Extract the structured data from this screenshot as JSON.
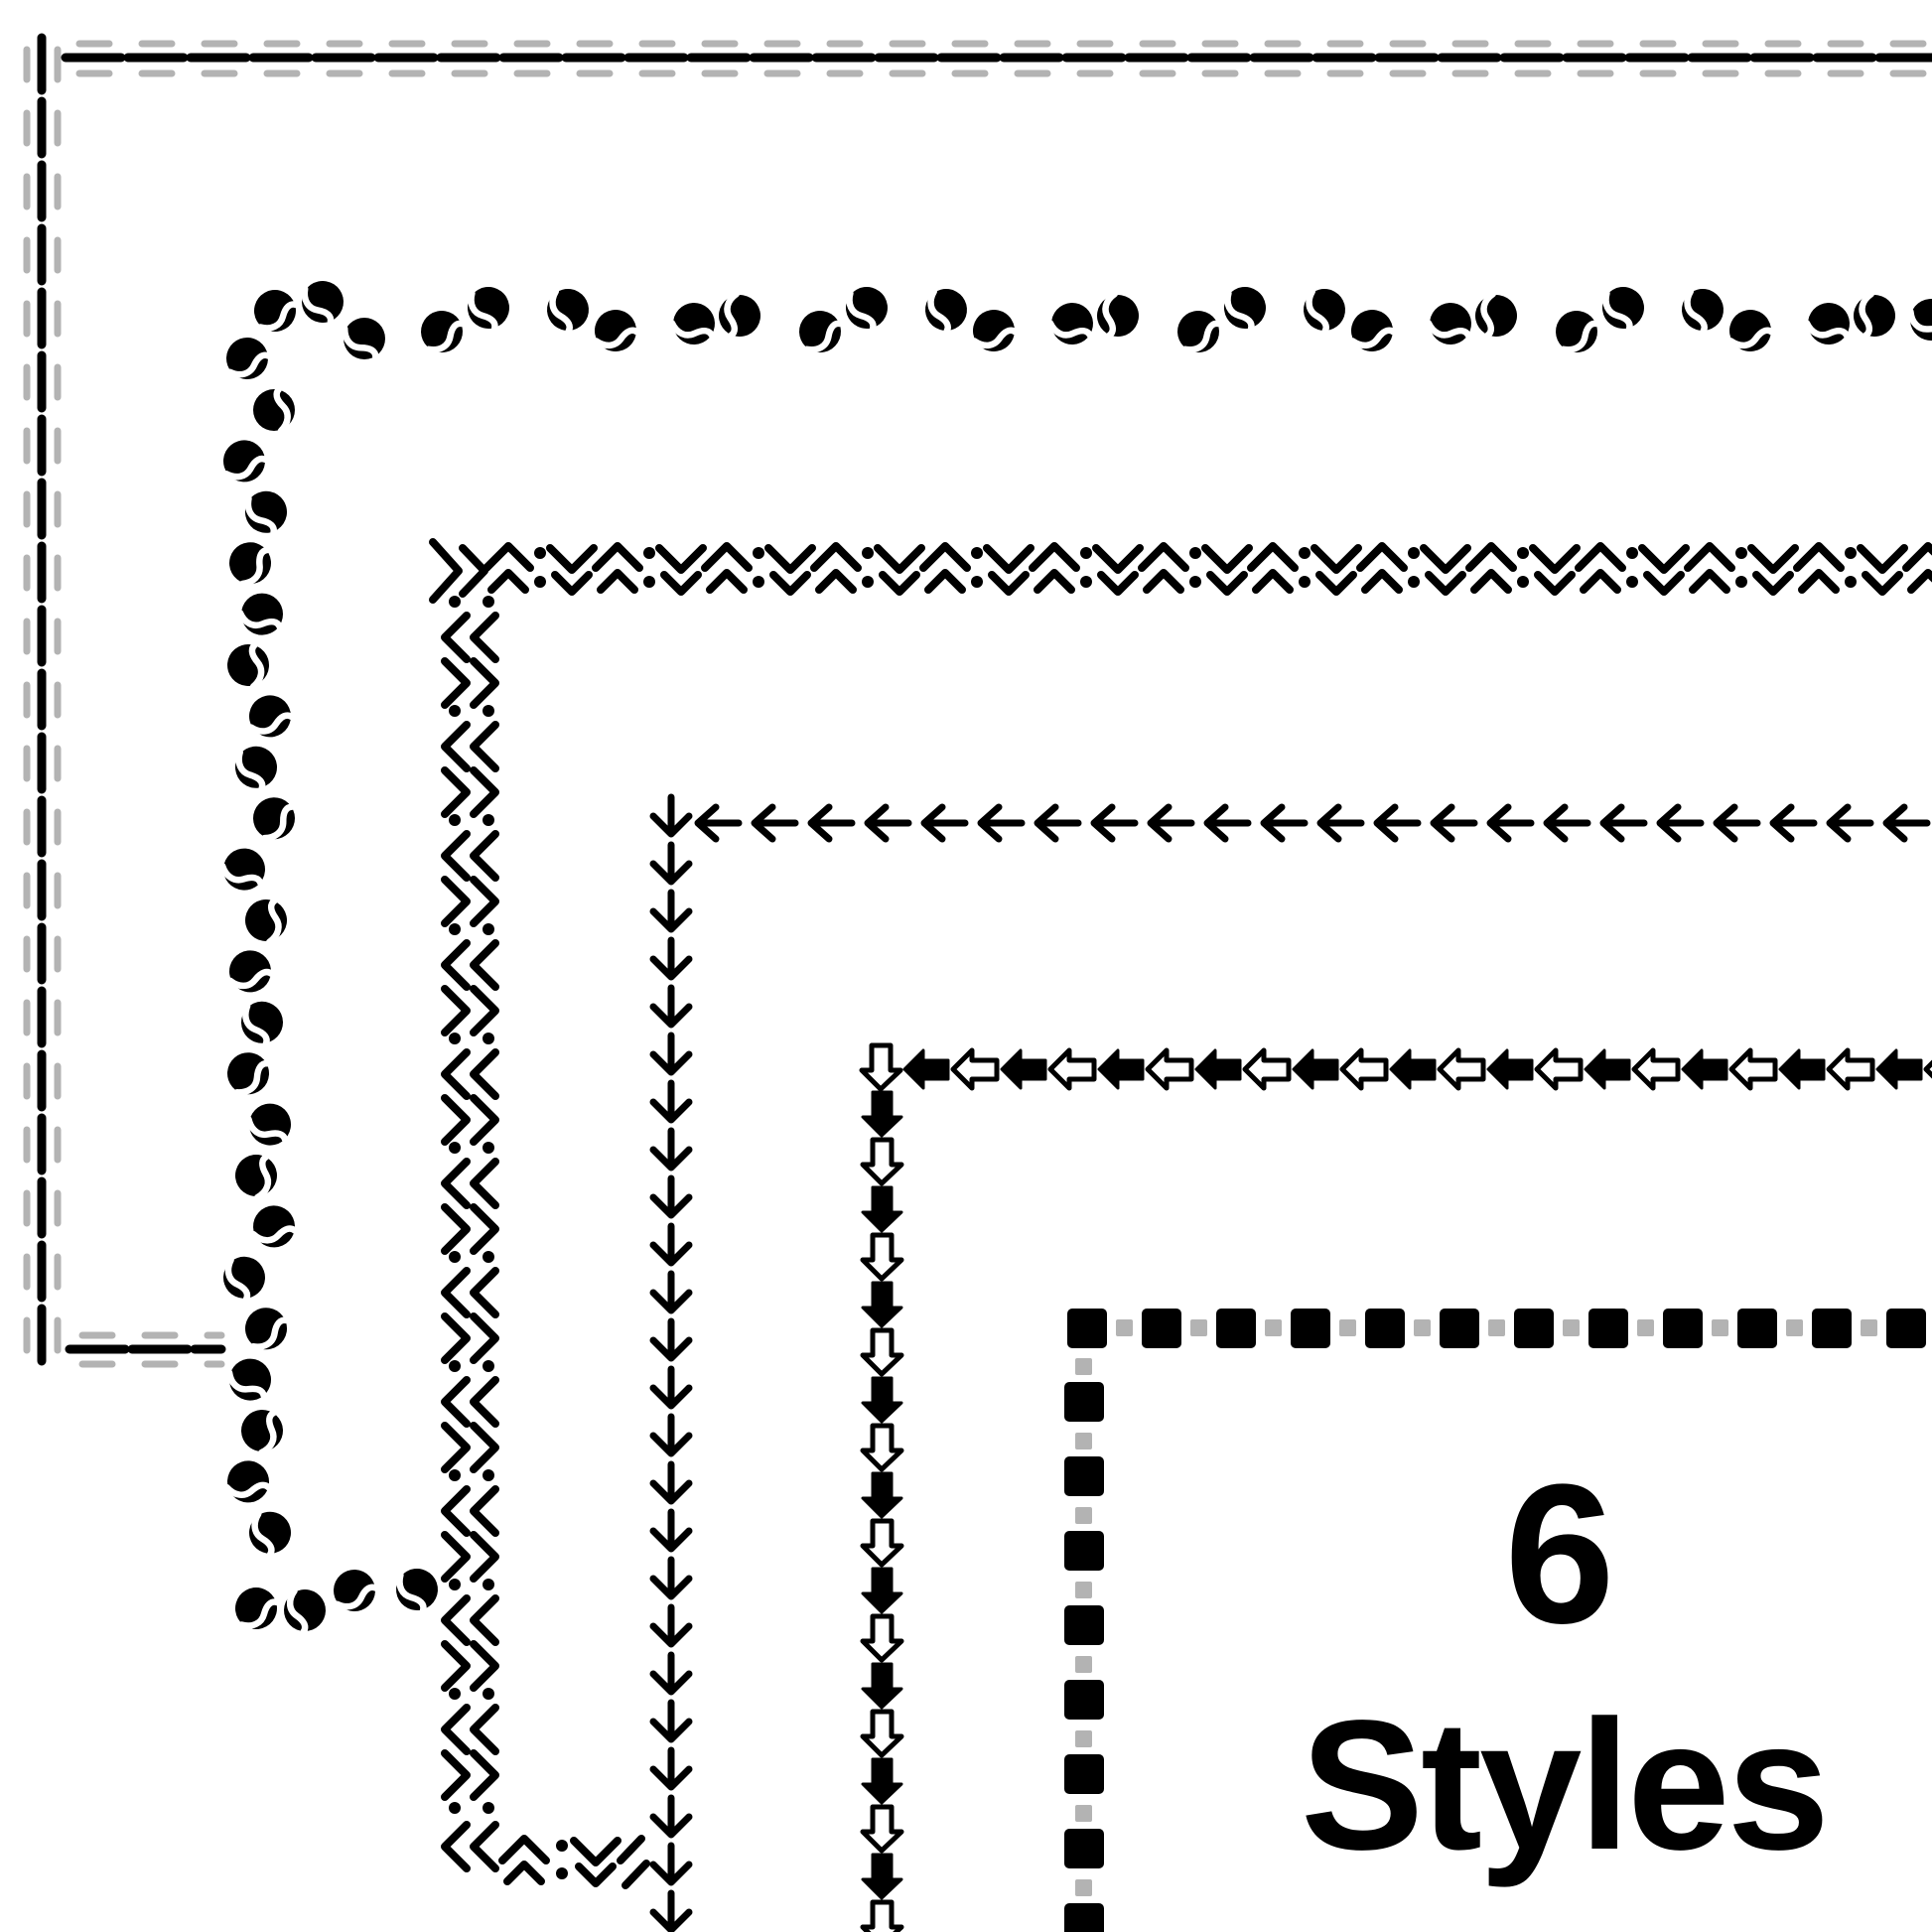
{
  "title": {
    "line1": "6",
    "line2": "Styles"
  },
  "colors": {
    "ink": "#000000",
    "accent_gray": "#b3b3b3",
    "background": "#ffffff"
  },
  "borders": [
    {
      "name": "double-dash-line-border",
      "description": "black dashed line flanked by offset gray dashed lines",
      "colors": [
        "#000000",
        "#b3b3b3"
      ]
    },
    {
      "name": "coffee-bean-border",
      "description": "scattered black coffee beans in pairs",
      "colors": [
        "#000000"
      ]
    },
    {
      "name": "chevron-dots-border",
      "description": "repeating double chevrons and dot pairs",
      "colors": [
        "#000000"
      ]
    },
    {
      "name": "thin-arrow-border",
      "description": "thin line arrows pointing left and down",
      "colors": [
        "#000000"
      ]
    },
    {
      "name": "block-arrow-border",
      "description": "alternating solid and outline block arrows",
      "colors": [
        "#000000",
        "#ffffff"
      ]
    },
    {
      "name": "square-dot-border",
      "description": "alternating large black squares and small gray squares",
      "colors": [
        "#000000",
        "#b3b3b3"
      ]
    }
  ]
}
